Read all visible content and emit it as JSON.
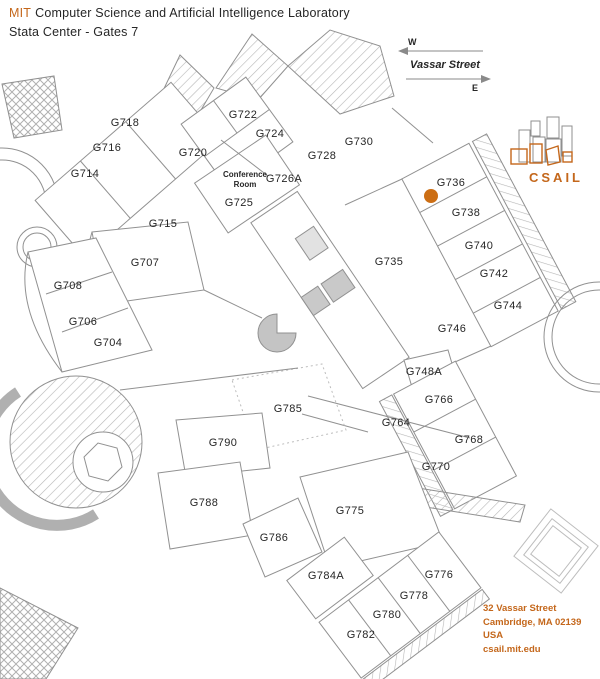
{
  "header": {
    "brand": "MIT",
    "title": "Computer Science and Artificial Intelligence Laboratory",
    "subtitle": "Stata Center - Gates 7"
  },
  "compass": {
    "west": "W",
    "east": "E",
    "street": "Vassar Street"
  },
  "logo": {
    "text": "CSAIL"
  },
  "address": {
    "line1": "32 Vassar Street",
    "line2": "Cambridge, MA 02139",
    "line3": "USA",
    "line4": "csail.mit.edu"
  },
  "colors": {
    "accent": "#c4671b",
    "marker": "#cc6e14",
    "plan_line": "#919191",
    "label": "#262626"
  },
  "map": {
    "marker_room": "G736",
    "conference": {
      "line1": "Conference",
      "line2": "Room",
      "number": "G725"
    },
    "rooms": [
      {
        "label": "G718"
      },
      {
        "label": "G716"
      },
      {
        "label": "G714"
      },
      {
        "label": "G722"
      },
      {
        "label": "G724"
      },
      {
        "label": "G720"
      },
      {
        "label": "G726A"
      },
      {
        "label": "G725"
      },
      {
        "label": "G728"
      },
      {
        "label": "G730"
      },
      {
        "label": "G736"
      },
      {
        "label": "G738"
      },
      {
        "label": "G740"
      },
      {
        "label": "G742"
      },
      {
        "label": "G744"
      },
      {
        "label": "G735"
      },
      {
        "label": "G715"
      },
      {
        "label": "G707"
      },
      {
        "label": "G708"
      },
      {
        "label": "G706"
      },
      {
        "label": "G704"
      },
      {
        "label": "G746"
      },
      {
        "label": "G748A"
      },
      {
        "label": "G766"
      },
      {
        "label": "G785"
      },
      {
        "label": "G764"
      },
      {
        "label": "G768"
      },
      {
        "label": "G790"
      },
      {
        "label": "G770"
      },
      {
        "label": "G788"
      },
      {
        "label": "G775"
      },
      {
        "label": "G786"
      },
      {
        "label": "G784A"
      },
      {
        "label": "G776"
      },
      {
        "label": "G778"
      },
      {
        "label": "G780"
      },
      {
        "label": "G782"
      }
    ]
  }
}
